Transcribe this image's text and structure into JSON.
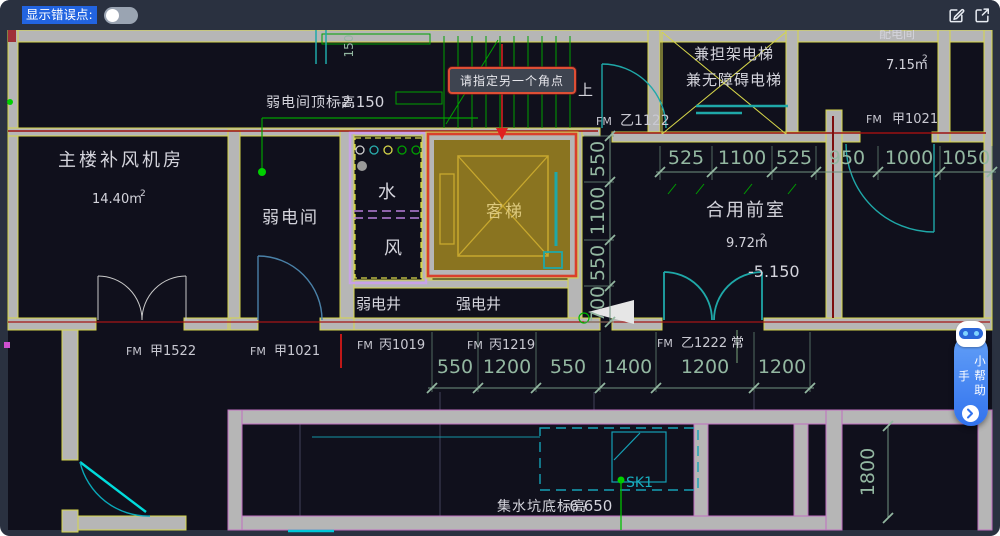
{
  "toolbar": {
    "error_points_label": "显示错误点:",
    "toggle_state": "off",
    "icons": {
      "edit": "edit-icon",
      "open_in_new": "open-in-new-icon"
    }
  },
  "tooltip": {
    "text": "请指定另一个角点"
  },
  "assistant": {
    "label": "小帮助手",
    "icons": {
      "robot": "robot-icon",
      "chevron": "chevron-right-icon"
    }
  },
  "strings": {
    "fm": "FM",
    "up": "上",
    "normally_open": "常",
    "sup2": "2"
  },
  "rooms": {
    "fan_room_name": "主楼补风机房",
    "fan_room_area": "14.40m",
    "weak_room_name": "弱电间",
    "shaft_water": "水",
    "shaft_wind": "风",
    "weak_well": "弱电井",
    "strong_well": "强电井",
    "elevator": "客梯",
    "lobby_name": "合用前室",
    "lobby_area": "9.72m",
    "lobby_level": "-5.150",
    "stretcher_line1": "兼担架电梯",
    "stretcher_line2": "兼无障碍电梯",
    "top_right_name": "配电间",
    "top_right_area": "7.15m"
  },
  "notes": {
    "weak_top_label": "弱电间顶标高",
    "weak_top_value": "-2.150",
    "sump_label": "集水坑底标高",
    "sump_value": "-6.650",
    "sk1": "SK1"
  },
  "doors": {
    "jia1522": "甲1522",
    "jia1021_bottom": "甲1021",
    "bing1019": "丙1019",
    "bing1219": "丙1219",
    "yi1222": "乙1222",
    "yi1122": "乙1122",
    "jia1021_top": "甲1021"
  },
  "dims": {
    "right": [
      "525",
      "1100",
      "525",
      "950",
      "1000",
      "1050"
    ],
    "bottom": [
      "550",
      "1200",
      "550",
      "1400",
      "1200",
      "1200"
    ],
    "left_vertical": [
      "550",
      "1100",
      "550",
      "700"
    ],
    "v1800": "1800",
    "v150": "150"
  }
}
